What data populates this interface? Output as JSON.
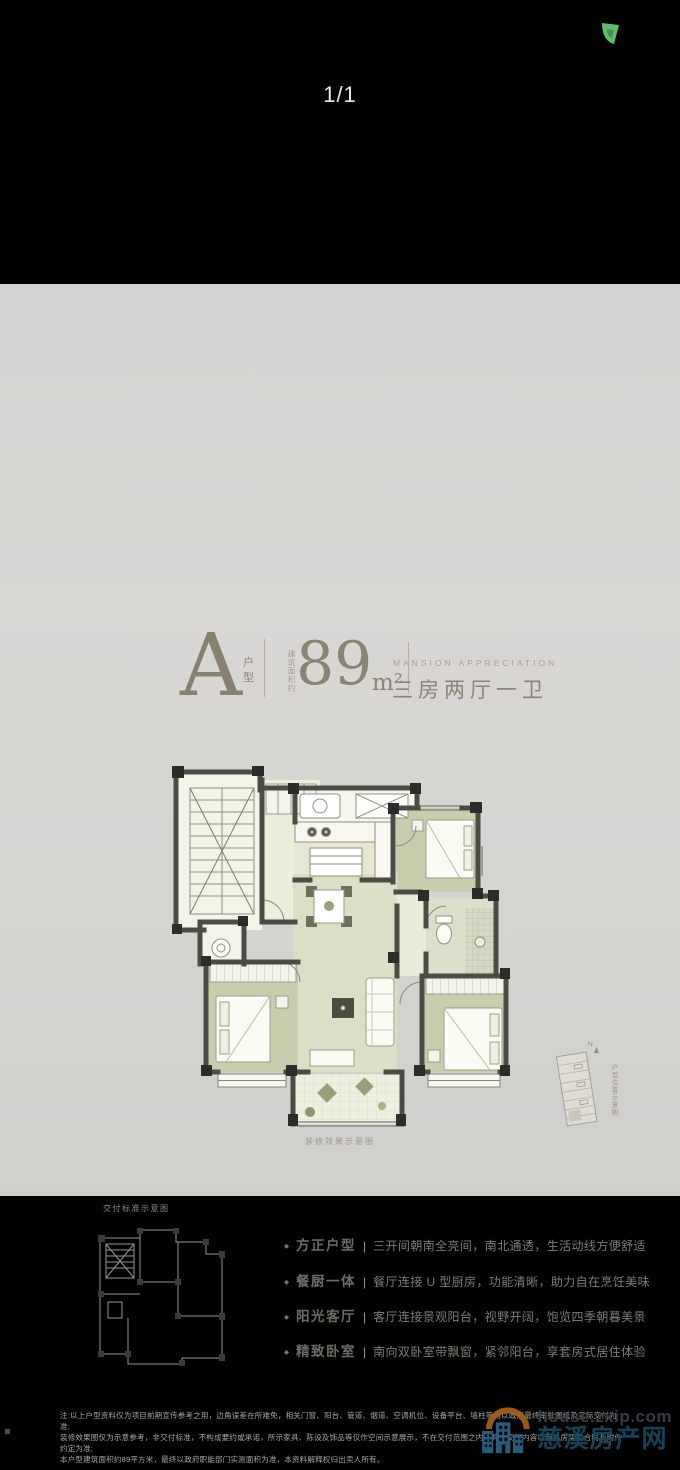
{
  "viewer": {
    "page_indicator": "1/1",
    "corner_icon": "green-crop-marker",
    "colors": {
      "background": "#000000",
      "indicator_text": "#e8e8e8",
      "corner_icon_green": "#5fbd6d"
    }
  },
  "card": {
    "colors": {
      "card_bg": "#d4d3d0",
      "title_taupe": "#8a8475",
      "feature_title": "#6c6b64",
      "feature_desc": "#7d7c74",
      "plan_wall": "#4c4c45",
      "plan_room_olive": "#c9cdad",
      "plan_room_cream": "#ededdc",
      "plan_room_sage": "#dbdfc5"
    },
    "header": {
      "unit_letter": "A",
      "unit_label": "户型",
      "area_prefix": "建筑面积约",
      "area_value": "89",
      "area_unit": "m²",
      "tagline_en": "MANSION APPRECIATION",
      "layout_text": "三房两厅一卫"
    },
    "plan_caption": "装修效果示意图",
    "delivery_plan_caption": "交付标准示意图",
    "position_diagram": {
      "compass": "N",
      "caption": "户型位置示意图"
    },
    "feature_bullet": "◆",
    "feature_divider": "|",
    "features": [
      {
        "title": "方正户型",
        "desc": "三开间朝南全亮间，南北通透，生活动线方便舒适"
      },
      {
        "title": "餐厨一体",
        "desc": "餐厅连接 U 型厨房，功能清晰，助力自在烹饪美味"
      },
      {
        "title": "阳光客厅",
        "desc": "客厅连接景观阳台，视野开阔，饱览四季朝暮美景"
      },
      {
        "title": "精致卧室",
        "desc": "南向双卧室带飘窗，紧邻阳台，享套房式居住体验"
      }
    ],
    "disclaimer_lines": [
      "注:以上户型资料仅为项目前期宣传参考之用，边角误差在所难免，相关门窗、阳台、管道、烟道、空调机位、设备平台、墙柱等均以政府最终审批图纸及实际交付为准;",
      "装修效果图仅为示意参考，非交付标准，不构成要约或承诺，所示家具、陈设及饰品等仅作空间示意展示，不在交付范围之内，具体交付内容以商品房买卖合同及附件约定为准;",
      "本户型建筑面积约89平方米，最终以政府职能部门实测面积为准，本资料解释权归出卖人所有。"
    ]
  },
  "watermark": {
    "site": "house.zxip.com",
    "name": "慈溪房产网",
    "colors": {
      "site_text": "#3c4249",
      "name_text": "#17475f",
      "building_blue": "#2e6286",
      "sun_orange": "#a96118"
    }
  }
}
